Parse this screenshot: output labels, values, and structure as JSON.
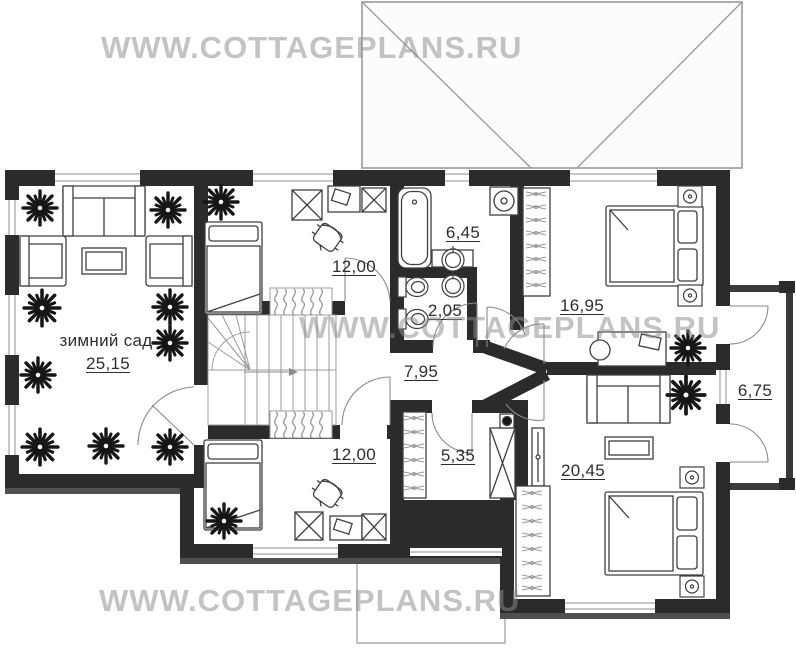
{
  "watermark": {
    "text": "WWW.COTTAGEPLANS.RU"
  },
  "plan": {
    "rooms": [
      {
        "key": "winter_garden",
        "name": "зимний сад",
        "area": "25,15"
      },
      {
        "key": "bedroom_top",
        "name": "",
        "area": "12,00"
      },
      {
        "key": "bathroom",
        "name": "",
        "area": "6,45"
      },
      {
        "key": "wc",
        "name": "",
        "area": "2,05"
      },
      {
        "key": "bedroom_right_top",
        "name": "",
        "area": "16,95"
      },
      {
        "key": "hall",
        "name": "",
        "area": "7,95"
      },
      {
        "key": "bedroom_bottom",
        "name": "",
        "area": "12,00"
      },
      {
        "key": "wardrobe",
        "name": "",
        "area": "5,35"
      },
      {
        "key": "bedroom_right_bottom",
        "name": "",
        "area": "20,45"
      },
      {
        "key": "balcony",
        "name": "",
        "area": "6,75"
      }
    ]
  }
}
